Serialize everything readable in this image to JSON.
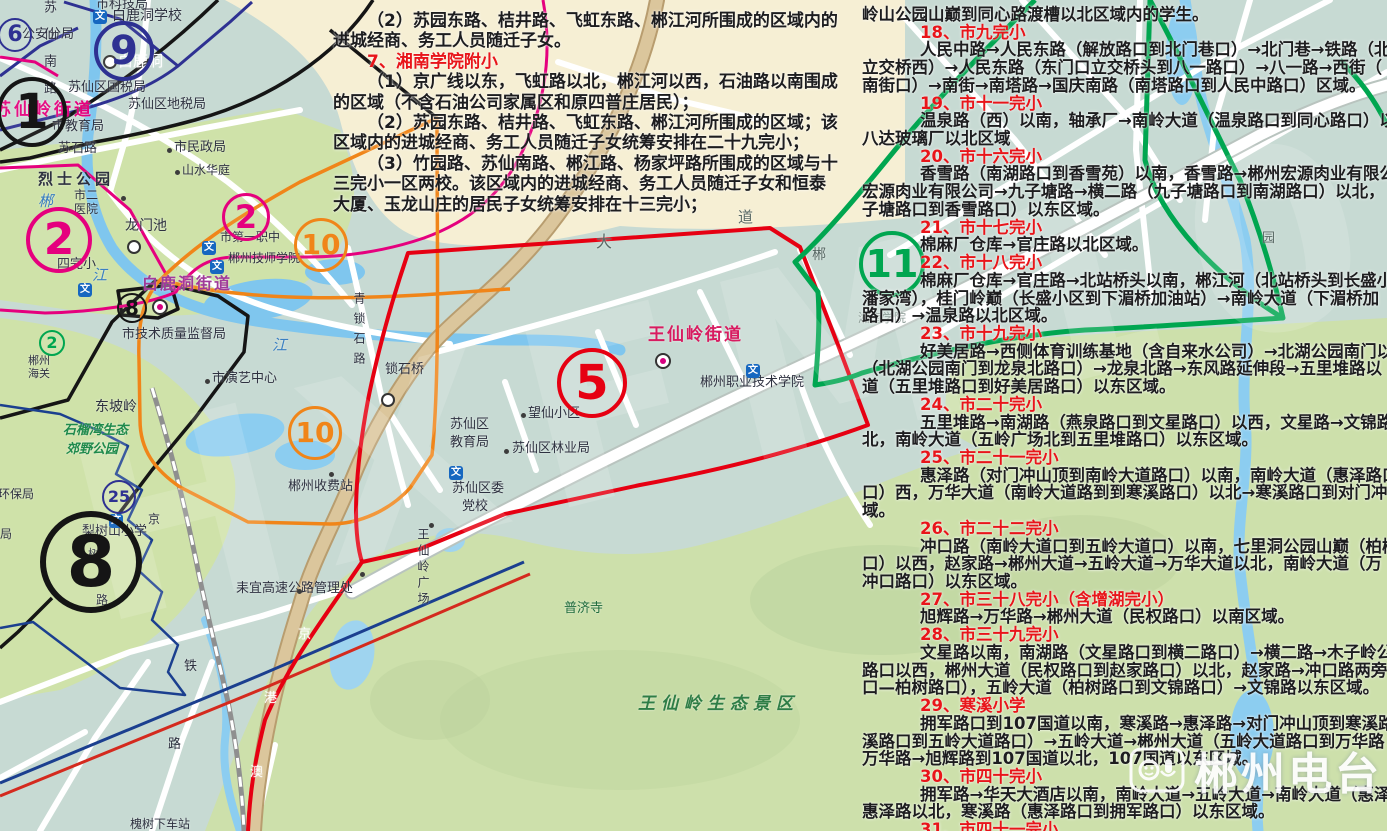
{
  "watermark": {
    "station": "郴州电台",
    "big": "HXFM102"
  },
  "left_text": {
    "x": 333,
    "y": 6,
    "lh": 20.4,
    "fs": 17,
    "indent": 34,
    "red": "#e8151a",
    "black": "#1d1d1f",
    "lines": [
      {
        "t": "（2）苏园东路、桔井路、飞虹东路、郴江河所围成的区域内的",
        "ind": true
      },
      {
        "t": "进城经商、务工人员随迁子女。"
      },
      {
        "t": "7、湘南学院附小",
        "red": true,
        "ind": true
      },
      {
        "t": "（1）京广线以东，飞虹路以北，郴江河以西，石油路以南围成",
        "ind": true
      },
      {
        "t": "的区域（不含石油公司家属区和原四普庄居民）；"
      },
      {
        "t": "（2）苏园东路、桔井路、飞虹东路、郴江河所围成的区域；该",
        "ind": true
      },
      {
        "t": "区域内的进城经商、务工人员随迁子女统筹安排在二十九完小；"
      },
      {
        "t": "（3）竹园路、苏仙南路、郴江路、杨家坪路所围成的区域与十",
        "ind": true
      },
      {
        "t": "三完小一区两校。该区域内的进城经商、务工人员随迁子女和恒泰"
      },
      {
        "t": "大厦、玉龙山庄的居民子女统筹安排在十三完小；"
      }
    ]
  },
  "right_text": {
    "x": 862,
    "y": 1,
    "lh": 17.72,
    "fs": 16.5,
    "indent": 58,
    "red": "#e8151a",
    "black": "#1d1d1f",
    "lines": [
      {
        "t": "岭山公园山巅到同心路渡槽以北区域内的学生。"
      },
      {
        "t": "18、市九完小",
        "red": true,
        "ind": true
      },
      {
        "t": "人民中路→人民东路（解放路口到北门巷口）→北门巷→铁路（北门",
        "ind": true
      },
      {
        "t": "立交桥西）→人民东路（东门口立交桥头到八一路口）→八一路→西街（"
      },
      {
        "t": "南街口）→南街→南塔路→国庆南路（南塔路口到人民中路口）区域。"
      },
      {
        "t": "19、市十一完小",
        "red": true,
        "ind": true
      },
      {
        "t": "温泉路（西）以南，轴承厂→南岭大道（温泉路口到同心路口）以西",
        "ind": true
      },
      {
        "t": "八达玻璃厂以北区域"
      },
      {
        "t": "20、市十六完小",
        "red": true,
        "ind": true
      },
      {
        "t": "香雪路（南湖路口到香雪苑）以南，香雪路→郴州宏源肉业有限公司",
        "ind": true
      },
      {
        "t": "宏源肉业有限公司→九子塘路→横二路（九子塘路口到南湖路口）以北，"
      },
      {
        "t": "子塘路口到香雪路口）以东区域。"
      },
      {
        "t": "21、市十七完小",
        "red": true,
        "ind": true
      },
      {
        "t": "棉麻厂仓库→官庄路以北区域。",
        "ind": true
      },
      {
        "t": "22、市十八完小",
        "red": true,
        "ind": true
      },
      {
        "t": "棉麻厂仓库→官庄路→北站桥头以南，郴江河（北站桥头到长盛小区",
        "ind": true
      },
      {
        "t": "潘家湾），桂门岭巅（长盛小区到下湄桥加油站）→南岭大道（下湄桥加"
      },
      {
        "t": "路口）→温泉路以北区域。"
      },
      {
        "t": "23、市十九完小",
        "red": true,
        "ind": true
      },
      {
        "t": "好美居路→西侧体育训练基地（含自来水公司）→北湖公园南门以南",
        "ind": true
      },
      {
        "t": "（北湖公园南门到龙泉北路口）→龙泉北路→东风路延伸段→五里堆路以"
      },
      {
        "t": "道（五里堆路口到好美居路口）以东区域。"
      },
      {
        "t": "24、市二十完小",
        "red": true,
        "ind": true
      },
      {
        "t": "五里堆路→南湖路（燕泉路口到文星路口）以西，文星路→文锦路→",
        "ind": true
      },
      {
        "t": "北，南岭大道（五岭广场北到五里堆路口）以东区域。"
      },
      {
        "t": "25、市二十一完小",
        "red": true,
        "ind": true
      },
      {
        "t": "惠泽路（对门冲山顶到南岭大道路口）以南，南岭大道（惠泽路口到",
        "ind": true
      },
      {
        "t": "口）西，万华大道（南岭大道路到到寒溪路口）以北→寒溪路口到对门冲"
      },
      {
        "t": "域。"
      },
      {
        "t": "26、市二十二完小",
        "red": true,
        "ind": true
      },
      {
        "t": "冲口路（南岭大道口到五岭大道口）以南，七里洞公园山巅（柏树路",
        "ind": true
      },
      {
        "t": "口）以西，赵家路→郴州大道→五岭大道→万华大道以北，南岭大道（万"
      },
      {
        "t": "冲口路口）以东区域。"
      },
      {
        "t": "27、市三十八完小（含增湖完小）",
        "red": true,
        "ind": true
      },
      {
        "t": "旭辉路→万华路→郴州大道（民权路口）以南区域。",
        "ind": true
      },
      {
        "t": "28、市三十九完小",
        "red": true,
        "ind": true
      },
      {
        "t": "文星路以南，南湖路（文星路口到横二路口）→横二路→木子岭公园",
        "ind": true
      },
      {
        "t": "路口以西，郴州大道（民权路口到赵家路口）以北，赵家路→冲口路两旁"
      },
      {
        "t": "口—柏树路口），五岭大道（柏树路口到文锦路口）→文锦路以东区域。"
      },
      {
        "t": "29、寒溪小学",
        "red": true,
        "ind": true
      },
      {
        "t": "拥军路口到107国道以南，寒溪路→惠泽路→对门冲山顶到寒溪路口",
        "ind": true
      },
      {
        "t": "溪路口到五岭大道路口）→五岭大道→郴州大道（五岭大道路口到万华路"
      },
      {
        "t": "万华路→旭辉路到107国道以北，107国道以东区域。"
      },
      {
        "t": "30、市四十完小",
        "red": true,
        "ind": true
      },
      {
        "t": "拥军路→华天大酒店以南，南岭大道→五岭大道→南岭大道（惠泽路",
        "ind": true
      },
      {
        "t": "惠泽路以北，寒溪路（惠泽路口到拥军路口）以东区域。"
      },
      {
        "t": "31、市四十一完小",
        "red": true,
        "ind": true
      }
    ]
  },
  "map_labels": [
    {
      "t": "市科技局",
      "x": 96,
      "y": -2,
      "s": 13
    },
    {
      "t": "白鹿洞学校",
      "x": 112,
      "y": 9,
      "s": 14
    },
    {
      "t": "公安分局",
      "x": 22,
      "y": 28,
      "s": 13
    },
    {
      "t": "白鹿洞",
      "x": 118,
      "y": 54,
      "s": 15,
      "c": "#ffffff"
    },
    {
      "t": "苏仙区国税局",
      "x": 68,
      "y": 81,
      "s": 13
    },
    {
      "t": "苏仙区地税局",
      "x": 128,
      "y": 98,
      "s": 13
    },
    {
      "t": "苏仙岭街道",
      "x": -6,
      "y": 102,
      "s": 17,
      "c": "#e5007e",
      "b": true,
      "ls": 3
    },
    {
      "t": "市教育局",
      "x": 52,
      "y": 120,
      "s": 13
    },
    {
      "t": "苏石路",
      "x": 58,
      "y": 142,
      "s": 13
    },
    {
      "t": "苏仙南路",
      "x": 42,
      "y": 0,
      "s": 13,
      "v": true,
      "ls": 14
    },
    {
      "t": "市民政局",
      "x": 174,
      "y": 141,
      "s": 13
    },
    {
      "t": "山水华庭",
      "x": 182,
      "y": 164,
      "s": 12
    },
    {
      "t": "烈士公园",
      "x": 38,
      "y": 172,
      "s": 15,
      "b": true,
      "ls": 4
    },
    {
      "t": "市二",
      "x": 74,
      "y": 189,
      "s": 12
    },
    {
      "t": "医院",
      "x": 74,
      "y": 203,
      "s": 12
    },
    {
      "t": "龙门池",
      "x": 125,
      "y": 219,
      "s": 14
    },
    {
      "t": "四完小",
      "x": 57,
      "y": 258,
      "s": 13
    },
    {
      "t": "白鹿洞街道",
      "x": 142,
      "y": 276,
      "s": 16,
      "c": "#a03a9a",
      "b": true,
      "ls": 2
    },
    {
      "t": "市第一职中",
      "x": 220,
      "y": 231,
      "s": 12
    },
    {
      "t": "郴州技师学院",
      "x": 228,
      "y": 252,
      "s": 12
    },
    {
      "t": "市技术质量监督局",
      "x": 122,
      "y": 328,
      "s": 13
    },
    {
      "t": "郴州",
      "x": 28,
      "y": 355,
      "s": 11
    },
    {
      "t": "海关",
      "x": 28,
      "y": 368,
      "s": 11
    },
    {
      "t": "市演艺中心",
      "x": 212,
      "y": 372,
      "s": 13
    },
    {
      "t": "东坡岭",
      "x": 95,
      "y": 400,
      "s": 14
    },
    {
      "t": "石榴湾生态",
      "x": 63,
      "y": 424,
      "s": 13,
      "c": "#1f8a4c",
      "i": true,
      "b": true
    },
    {
      "t": "郊野公园",
      "x": 66,
      "y": 443,
      "s": 13,
      "c": "#1f8a4c",
      "i": true,
      "b": true
    },
    {
      "t": "环保局",
      "x": -2,
      "y": 488,
      "s": 12
    },
    {
      "t": "局",
      "x": 0,
      "y": 528,
      "s": 12
    },
    {
      "t": "梨树山小学",
      "x": 82,
      "y": 525,
      "s": 13
    },
    {
      "t": "树",
      "x": 88,
      "y": 548,
      "s": 12
    },
    {
      "t": "路",
      "x": 96,
      "y": 594,
      "s": 12
    },
    {
      "t": "京",
      "x": 148,
      "y": 513,
      "s": 12
    },
    {
      "t": "郴州收费站",
      "x": 288,
      "y": 480,
      "s": 13
    },
    {
      "t": "耒宜高速公路管理处",
      "x": 236,
      "y": 582,
      "s": 13
    },
    {
      "t": "王仙岭广场",
      "x": 417,
      "y": 528,
      "s": 12,
      "v": true,
      "ls": 4
    },
    {
      "t": "普济寺",
      "x": 564,
      "y": 602,
      "s": 13,
      "c": "#1e6b3c"
    },
    {
      "t": "王仙岭生态景区",
      "x": 638,
      "y": 696,
      "s": 17,
      "c": "#2e7d46",
      "i": true,
      "b": true,
      "ls": 6
    },
    {
      "t": "锁石桥",
      "x": 385,
      "y": 363,
      "s": 13
    },
    {
      "t": "青锁石路",
      "x": 353,
      "y": 292,
      "s": 12,
      "v": true,
      "ls": 8
    },
    {
      "t": "望仙小区",
      "x": 528,
      "y": 407,
      "s": 13
    },
    {
      "t": "苏仙区",
      "x": 450,
      "y": 418,
      "s": 13
    },
    {
      "t": "教育局",
      "x": 450,
      "y": 436,
      "s": 13
    },
    {
      "t": "苏仙区林业局",
      "x": 512,
      "y": 442,
      "s": 13
    },
    {
      "t": "苏仙区委",
      "x": 452,
      "y": 482,
      "s": 13
    },
    {
      "t": "党校",
      "x": 462,
      "y": 500,
      "s": 13
    },
    {
      "t": "王仙岭街道",
      "x": 648,
      "y": 327,
      "s": 17,
      "c": "#d81b60",
      "b": true,
      "ls": 2
    },
    {
      "t": "郴州职业技术学院",
      "x": 700,
      "y": 376,
      "s": 13
    },
    {
      "t": "湘南学院",
      "x": 858,
      "y": 312,
      "s": 12,
      "c": "#8a9a94"
    },
    {
      "t": "郴",
      "x": 38,
      "y": 194,
      "s": 15,
      "c": "#3a7fc1",
      "i": true
    },
    {
      "t": "江",
      "x": 92,
      "y": 268,
      "s": 15,
      "c": "#3a7fc1",
      "i": true
    },
    {
      "t": "江",
      "x": 272,
      "y": 338,
      "s": 15,
      "c": "#3a7fc1",
      "i": true
    },
    {
      "t": "大",
      "x": 596,
      "y": 234,
      "s": 16,
      "c": "#5a6a66"
    },
    {
      "t": "道",
      "x": 738,
      "y": 210,
      "s": 15,
      "c": "#5a6a66"
    },
    {
      "t": "郴",
      "x": 812,
      "y": 248,
      "s": 14,
      "c": "#5a6a66"
    },
    {
      "t": "园",
      "x": 1262,
      "y": 232,
      "s": 13,
      "c": "#5a6a66"
    },
    {
      "t": "铁",
      "x": 184,
      "y": 660,
      "s": 13
    },
    {
      "t": "路",
      "x": 168,
      "y": 738,
      "s": 13
    },
    {
      "t": "京",
      "x": 298,
      "y": 628,
      "s": 13,
      "c": "#ffffff"
    },
    {
      "t": "港",
      "x": 264,
      "y": 692,
      "s": 13,
      "c": "#ffffff"
    },
    {
      "t": "澳",
      "x": 250,
      "y": 766,
      "s": 13,
      "c": "#ffffff"
    },
    {
      "t": "槐树下车站",
      "x": 130,
      "y": 818,
      "s": 12
    }
  ],
  "badges": [
    {
      "n": "6",
      "x": 13,
      "y": 33,
      "r": 15,
      "c": "#2e3192",
      "fs": 22
    },
    {
      "n": "9",
      "x": 120,
      "y": 47,
      "r": 26,
      "c": "#2e3192",
      "fs": 40
    },
    {
      "n": "1",
      "x": 28,
      "y": 108,
      "r": 31,
      "c": "#151515",
      "fs": 48
    },
    {
      "n": "2",
      "x": 55,
      "y": 236,
      "r": 29,
      "c": "#e5007e",
      "fs": 44
    },
    {
      "n": "2",
      "x": 243,
      "y": 214,
      "r": 21,
      "c": "#e5007e",
      "fs": 32
    },
    {
      "n": "8",
      "x": 130,
      "y": 306,
      "r": 13,
      "c": "#151515",
      "fs": 20
    },
    {
      "n": "2",
      "x": 50,
      "y": 341,
      "r": 11,
      "c": "#00a650",
      "fs": 16
    },
    {
      "n": "10",
      "x": 318,
      "y": 242,
      "r": 24,
      "c": "#f08519",
      "fs": 28
    },
    {
      "n": "10",
      "x": 312,
      "y": 430,
      "r": 24,
      "c": "#f08519",
      "fs": 28
    },
    {
      "n": "8",
      "x": 85,
      "y": 556,
      "r": 45,
      "c": "#151515",
      "fs": 70
    },
    {
      "n": "25",
      "x": 117,
      "y": 495,
      "r": 15,
      "c": "#2e3192",
      "fs": 16
    },
    {
      "n": "5",
      "x": 588,
      "y": 379,
      "r": 31,
      "c": "#e60012",
      "fs": 48
    },
    {
      "n": "11",
      "x": 888,
      "y": 260,
      "r": 29,
      "c": "#00a650",
      "fs": 38
    }
  ],
  "school_icon_text": "文",
  "wen_icons": [
    {
      "x": 93,
      "y": 10
    },
    {
      "x": 78,
      "y": 283
    },
    {
      "x": 202,
      "y": 241
    },
    {
      "x": 210,
      "y": 260
    },
    {
      "x": 449,
      "y": 466
    },
    {
      "x": 746,
      "y": 364
    },
    {
      "x": 109,
      "y": 514
    }
  ],
  "ring_markers": [
    {
      "x": 103,
      "y": 55
    },
    {
      "x": 127,
      "y": 240
    },
    {
      "x": 381,
      "y": 393
    }
  ],
  "office_markers": [
    {
      "x": 152,
      "y": 299
    },
    {
      "x": 655,
      "y": 353
    }
  ],
  "poi_dots": [
    {
      "x": 167,
      "y": 148
    },
    {
      "x": 175,
      "y": 170
    },
    {
      "x": 521,
      "y": 413
    },
    {
      "x": 504,
      "y": 449
    },
    {
      "x": 205,
      "y": 379
    },
    {
      "x": 329,
      "y": 472
    },
    {
      "x": 360,
      "y": 572
    },
    {
      "x": 429,
      "y": 523
    },
    {
      "x": 297,
      "y": 589
    },
    {
      "x": 121,
      "y": 196
    }
  ]
}
